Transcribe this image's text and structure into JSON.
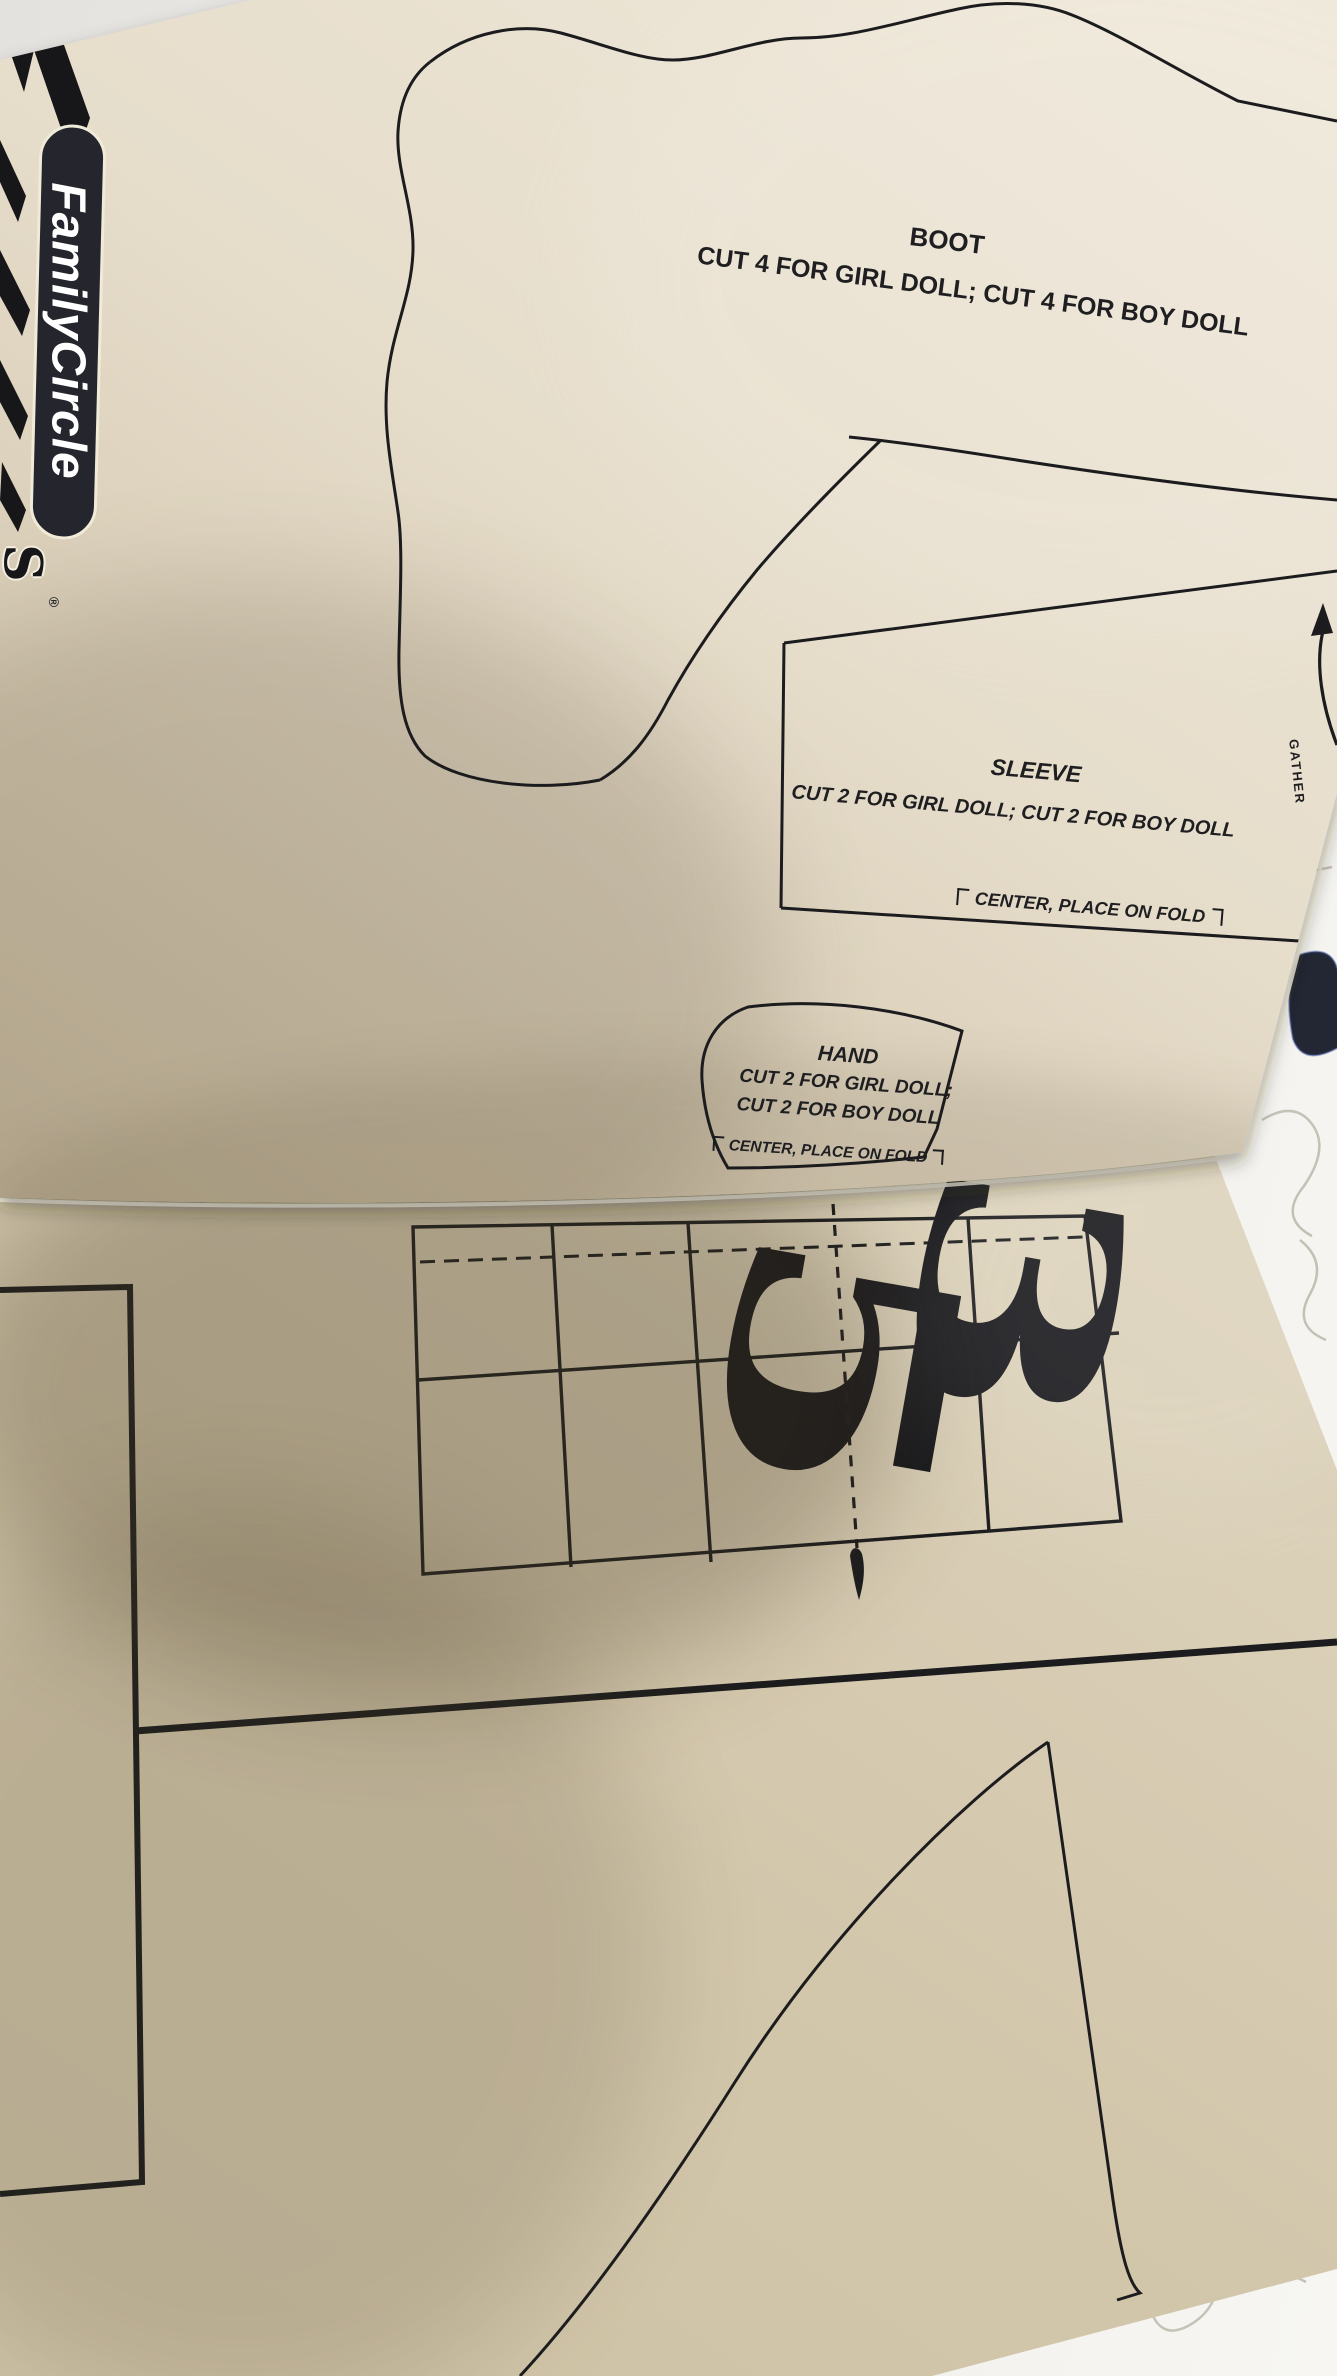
{
  "image": {
    "type": "photograph",
    "subject": "Family Circle Weekend Crafts doll-pattern book pages lying on a table"
  },
  "colors": {
    "ink": "#1c1c1e",
    "upper_page": "#e8e0d0",
    "lower_page": "#d6cbb3",
    "logo_pill": "#25252d",
    "table_white": "#f2f0ea",
    "navy_mark": "#232734"
  },
  "logo": {
    "brand": "FamilyCircle",
    "series_initial": "S",
    "registered_mark": "®"
  },
  "pieces": {
    "boot": {
      "title": "BOOT",
      "cutting_note": "CUT 4 FOR GIRL DOLL; CUT 4 FOR BOY DOLL"
    },
    "sleeve": {
      "title": "SLEEVE",
      "cutting_note": "CUT 2 FOR GIRL DOLL; CUT 2 FOR BOY DOLL",
      "fold_note": "CENTER, PLACE ON FOLD",
      "gather_label": "GATHER"
    },
    "hand": {
      "title": "HAND",
      "cutting_note_line1": "CUT 2 FOR GIRL DOLL;",
      "cutting_note_line2": "CUT 2 FOR BOY DOLL",
      "fold_note": "CENTER, PLACE ON FOLD"
    }
  },
  "page_number": {
    "left_digit": "5",
    "right_digit": "3"
  }
}
